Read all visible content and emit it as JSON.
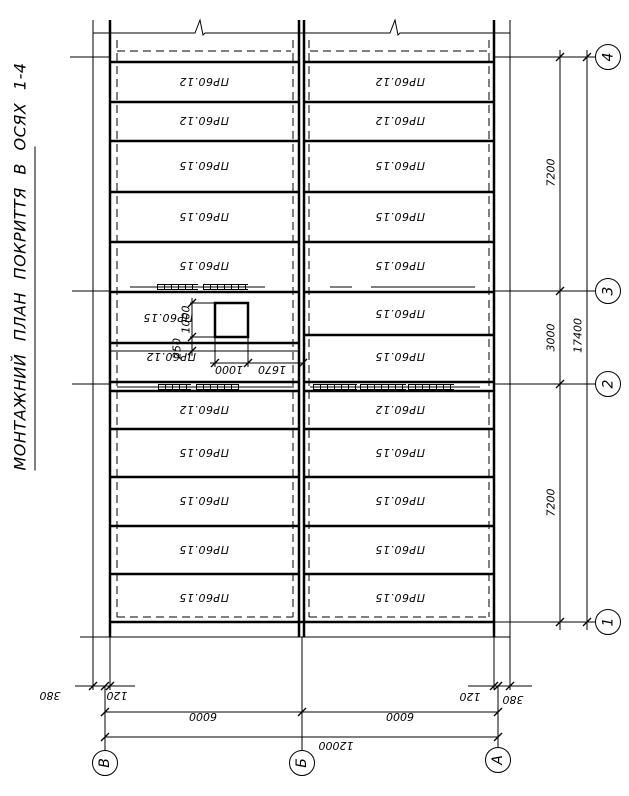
{
  "title": "МОНТАЖНИЙ ПЛАН ПОКРИТТЯ В ОСЯХ 1-4",
  "panels": {
    "upper": {
      "left": [
        "ПР60.12",
        "ПР60.12",
        "ПР60.15",
        "ПР60.15",
        "ПР60.15"
      ],
      "right": [
        "ПР60.12",
        "ПР60.12",
        "ПР60.15",
        "ПР60.15",
        "ПР60.15"
      ]
    },
    "middle": {
      "left": [
        "ПР60.15",
        "ПР60.12"
      ],
      "right": [
        "ПР60.15",
        "ПР60.15"
      ]
    },
    "lower": {
      "left": [
        "ПР60.12",
        "ПР60.15",
        "ПР60.15",
        "ПР60.15",
        "ПР60.15"
      ],
      "right": [
        "ПР60.12",
        "ПР60.15",
        "ПР60.15",
        "ПР60.15",
        "ПР60.15"
      ]
    }
  },
  "axis_circles": {
    "right_top_to_bottom": [
      "4",
      "3",
      "2",
      "1"
    ],
    "bottom_left_to_right": [
      "В",
      "Б",
      "А"
    ]
  },
  "dims": {
    "right": {
      "seg_4_3": "7200",
      "seg_3_2": "3000",
      "seg_2_1": "7200",
      "total": "17400"
    },
    "bottom": {
      "left_380": "380",
      "left_120": "120",
      "bay_left": "6000",
      "bay_right": "6000",
      "right_120": "120",
      "right_380": "380",
      "total": "12000"
    },
    "opening": {
      "height": "1000",
      "gap": "250",
      "width": "1000",
      "offset": "1670"
    }
  },
  "colors": {
    "ink": "#000000",
    "paper": "#ffffff"
  }
}
